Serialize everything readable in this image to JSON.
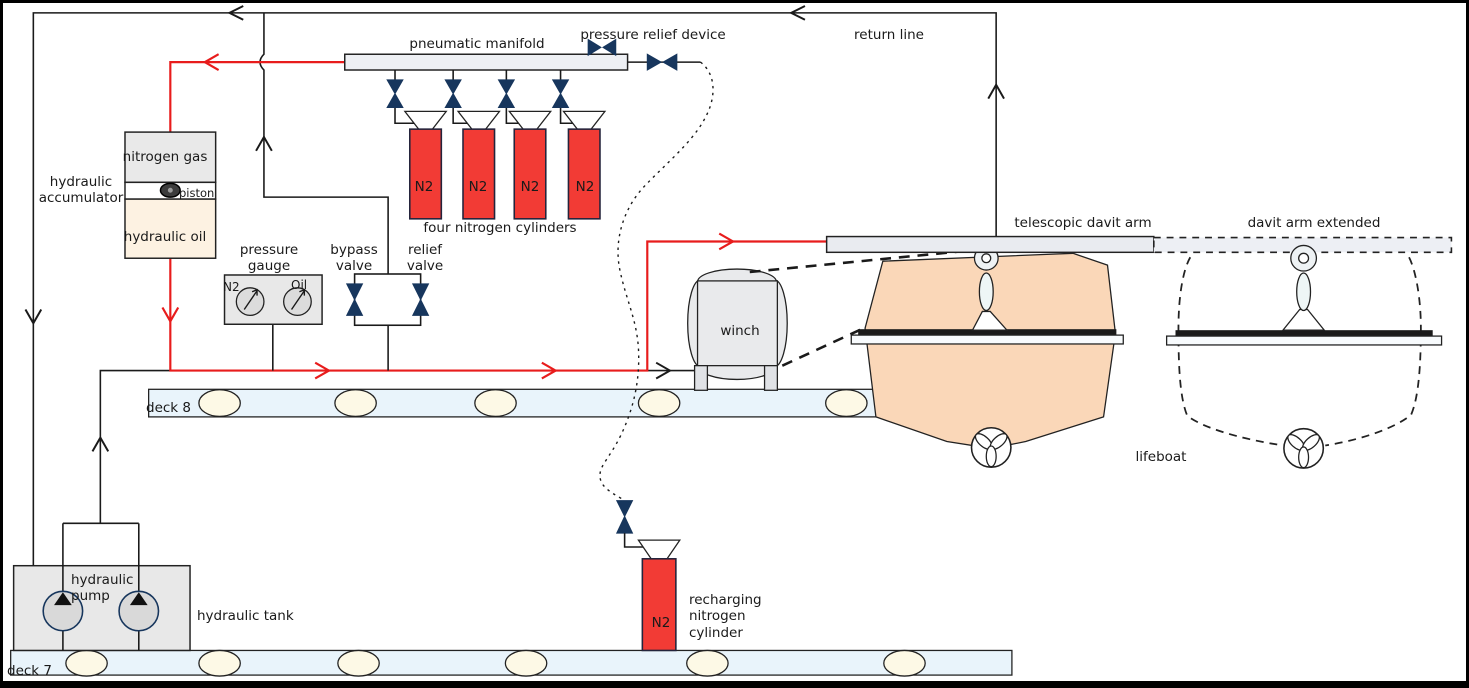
{
  "diagram_title": "lifeboat davit hydraulic and pneumatic launching system",
  "labels": {
    "pneumatic_manifold": "pneumatic manifold",
    "pressure_relief_device": "pressure relief device",
    "return_line": "return line",
    "hydraulic_accumulator": "hydraulic\naccumulator",
    "nitrogen_gas": "nitrogen gas",
    "piston": "piston",
    "hydraulic_oil": "hydraulic oil",
    "four_nitrogen_cylinders": "four nitrogen cylinders",
    "n2": "N2",
    "pressure_gauge": "pressure\ngauge",
    "gauge_n2": "N2",
    "gauge_oil": "Oil",
    "bypass_valve": "bypass\nvalve",
    "relief_valve": "relief\nvalve",
    "winch": "winch",
    "telescopic_davit_arm": "telescopic davit arm",
    "davit_arm_extended": "davit arm extended",
    "lifeboat": "lifeboat",
    "deck8": "deck 8",
    "deck7": "deck 7",
    "hydraulic_pump": "hydraulic\npump",
    "hydraulic_tank": "hydraulic tank",
    "recharging_nitrogen_cylinder": "recharging\nnitrogen\ncylinder"
  },
  "colors": {
    "supply_line_red": "#e81c1c",
    "return_line_black": "#1a1a1a",
    "valve_navy": "#17365d",
    "cylinder_red": "#f23b35",
    "lifeboat_peach": "#fad7b8",
    "deck_blue": "#e9f4fb",
    "deck_ellipse_cream": "#fdf9e6",
    "nitrogen_gray": "#e9e9e9",
    "oil_cream": "#fdf2e2",
    "manifold_gray": "#eef0f4",
    "davit_arm_gray": "#e9ebf0",
    "winch_gray": "#e9eaec",
    "tank_gray": "#e8e8e8",
    "gauge_face_gray": "#dcdcdc"
  },
  "components": {
    "nitrogen_cylinder_count": 4,
    "pump_count": 2,
    "gauge_count": 2
  }
}
